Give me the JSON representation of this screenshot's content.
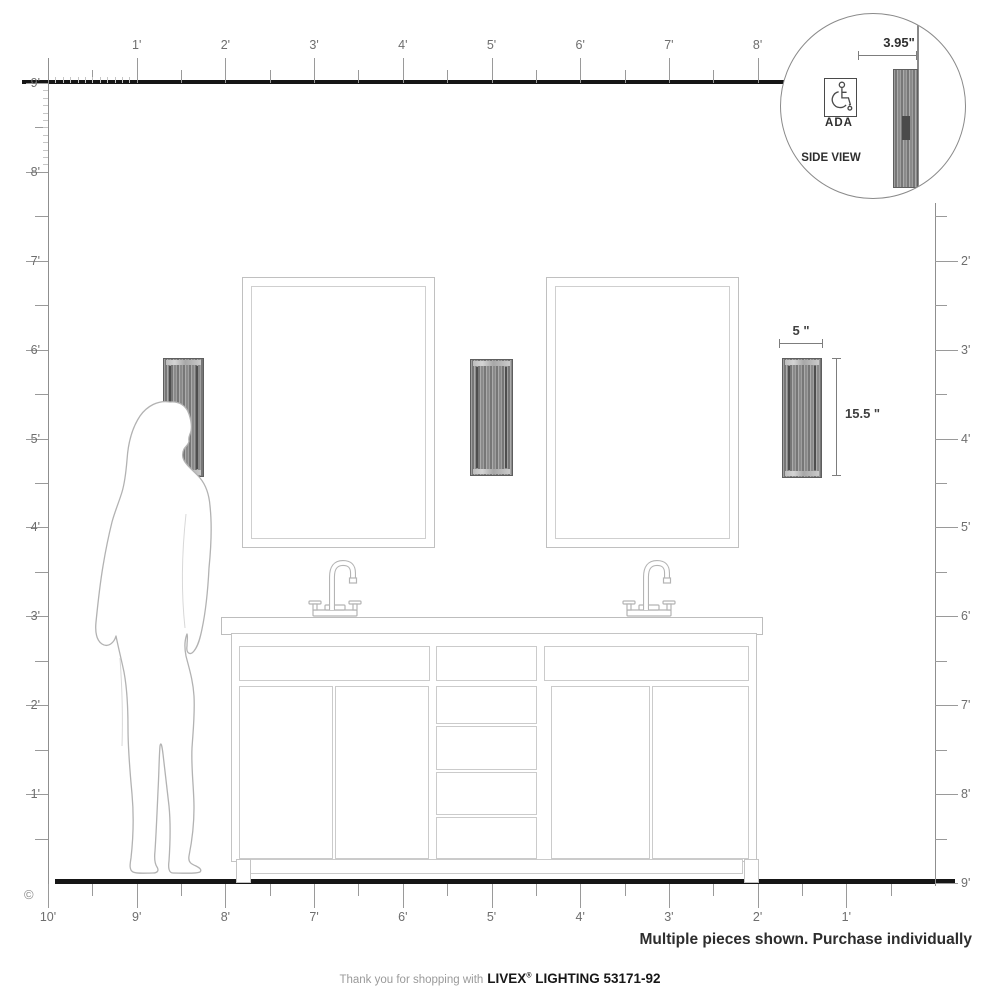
{
  "diagram": {
    "copyright": "©",
    "purchase_note": "Multiple pieces shown. Purchase individually"
  },
  "rulers": {
    "top": {
      "labels": [
        "1'",
        "2'",
        "3'",
        "4'",
        "5'",
        "6'",
        "7'",
        "8'"
      ]
    },
    "left": {
      "labels": [
        "9'",
        "8'",
        "7'",
        "6'",
        "5'",
        "4'",
        "3'",
        "2'",
        "1'"
      ]
    },
    "right": {
      "labels": [
        "2'",
        "3'",
        "4'",
        "5'",
        "6'",
        "7'",
        "8'",
        "9'"
      ]
    },
    "bottom": {
      "labels": [
        "10'",
        "9'",
        "8'",
        "7'",
        "6'",
        "5'",
        "4'",
        "3'",
        "2'",
        "1'"
      ]
    }
  },
  "inset": {
    "depth_dimension": "3.95\"",
    "ada_label": "ADA",
    "view_label": "SIDE VIEW"
  },
  "fixture": {
    "width_dimension": "5 \"",
    "height_dimension": "15.5 \""
  },
  "footer": {
    "prefix": "Thank you for shopping with",
    "brand": "LIVEX",
    "registered": "®",
    "suffix": "LIGHTING 53171-92"
  },
  "colors": {
    "heavy_line": "#161616",
    "ruler_line": "#8f8f8f",
    "outline_line": "#c0c0c0",
    "sconce_dark": "#6e6e6e",
    "text_dark": "#2e2e2e",
    "text_gray": "#6e6e6e"
  }
}
